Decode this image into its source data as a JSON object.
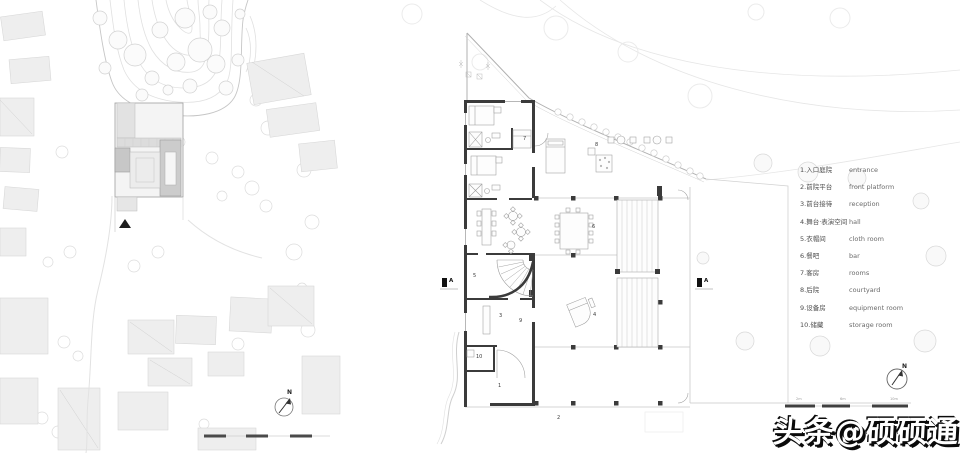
{
  "site_plan": {
    "north_label": "N"
  },
  "floor_plan": {
    "north_label": "N",
    "section_label": "A",
    "rooms": [
      {
        "num": "1"
      },
      {
        "num": "2"
      },
      {
        "num": "3"
      },
      {
        "num": "4"
      },
      {
        "num": "5"
      },
      {
        "num": "6"
      },
      {
        "num": "7"
      },
      {
        "num": "8"
      },
      {
        "num": "9"
      },
      {
        "num": "10"
      }
    ],
    "scale_labels": [
      "2m",
      "6m",
      "10m"
    ]
  },
  "legend": {
    "items": [
      {
        "zh": "1.入口庭院",
        "en": "entrance"
      },
      {
        "zh": "2.前院平台",
        "en": "front platform"
      },
      {
        "zh": "3.前台接待",
        "en": "reception"
      },
      {
        "zh": "4.舞台·表演空间",
        "en": "hall"
      },
      {
        "zh": "5.衣帽间",
        "en": "cloth room"
      },
      {
        "zh": "6.餐吧",
        "en": "bar"
      },
      {
        "zh": "7.客房",
        "en": "rooms"
      },
      {
        "zh": "8.后院",
        "en": "courtyard"
      },
      {
        "zh": "9.设备房",
        "en": "equipment room"
      },
      {
        "zh": "10.储藏",
        "en": "storage room"
      }
    ]
  },
  "watermark": {
    "text": "头条@硕硕通"
  }
}
